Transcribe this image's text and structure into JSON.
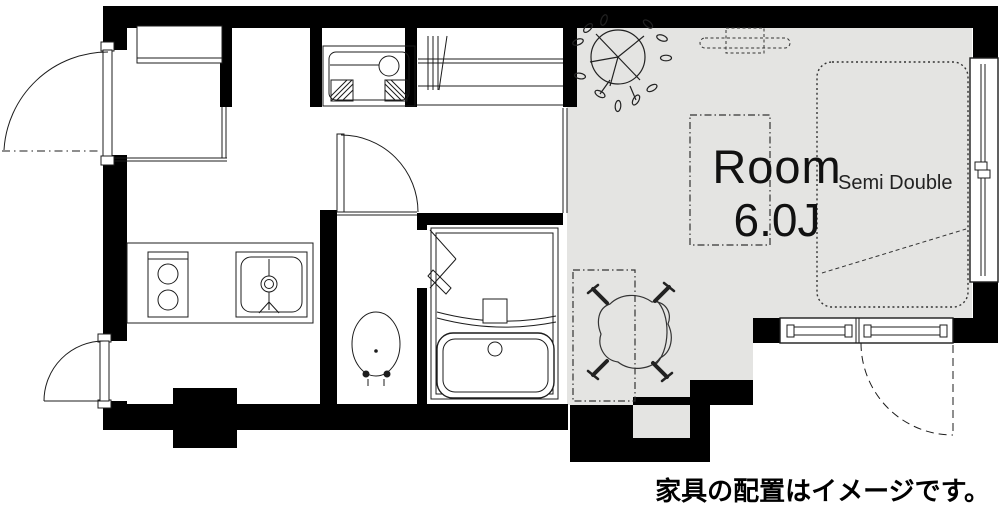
{
  "floorplan": {
    "room": {
      "label": "Room",
      "size": "6.0J"
    },
    "bed": {
      "label": "Semi Double"
    },
    "caption": "家具の配置はイメージです。",
    "colors": {
      "wall": "#000000",
      "floor": "#e4e4e2",
      "background": "#ffffff",
      "line": "#1c1c1c"
    },
    "symbols": {
      "entry_door": "entry-door",
      "service_door": "service-door",
      "shoe_cabinet": "shoe-cabinet",
      "washing_machine_pan": "washing-machine-pan",
      "closet_hanger_pipe": "closet-hanger-pipe",
      "kitchen_stove": "kitchen-stove",
      "kitchen_sink": "kitchen-sink",
      "toilet": "toilet",
      "bathtub": "bathtub",
      "folding_door": "folding-door",
      "sliding_window_right": "sliding-window",
      "balcony_window": "balcony-window",
      "bed": "semi-double-bed",
      "desk": "desk",
      "table": "table",
      "chair": "chair",
      "plant": "plant",
      "ceiling_light": "ceiling-light"
    }
  }
}
